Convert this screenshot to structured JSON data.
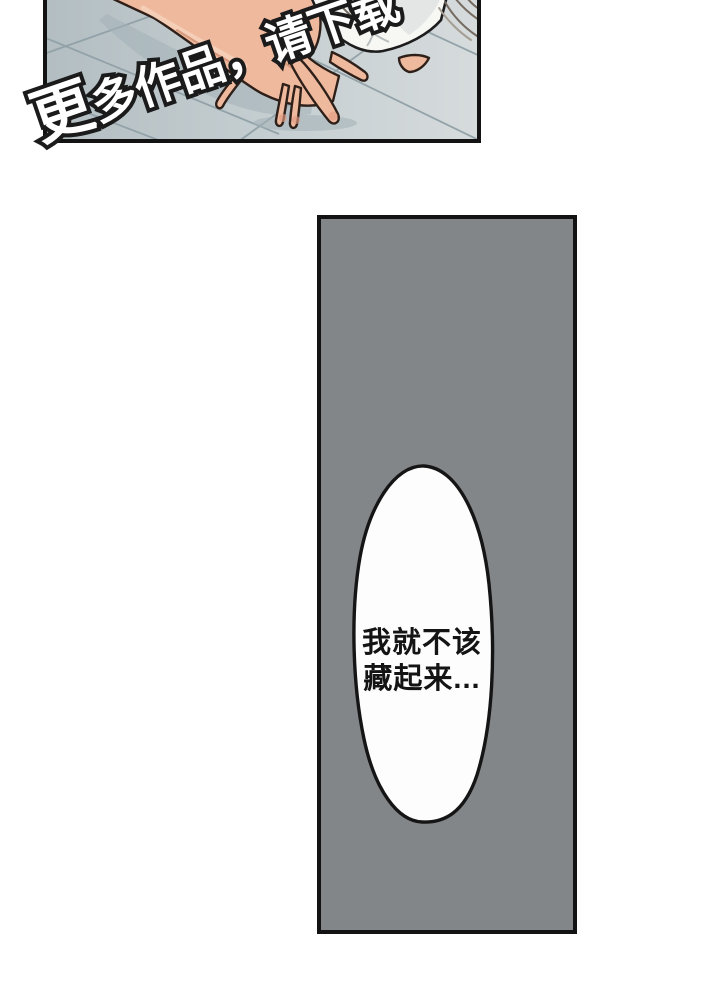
{
  "watermark": {
    "text": "更多作品，请下载"
  },
  "speech_bubble": {
    "line1": "我就不该",
    "line2": "藏起来..."
  },
  "colors": {
    "panel_border": "#131313",
    "gray_panel_fill": "#828689",
    "tile_light": "#d6dbdc",
    "tile_mid": "#c6cfd2",
    "tile_dark": "#b3bec2",
    "grout": "#8fa0a6",
    "skin": "#efb99e",
    "skin_shadow": "#dd9579",
    "skin_outline": "#2e2019",
    "fabric": "#f7f7f4",
    "bubble_fill": "#fdfdfd",
    "text": "#141414",
    "watermark_fill": "#ffffff",
    "watermark_outline": "#1b1b1b"
  }
}
